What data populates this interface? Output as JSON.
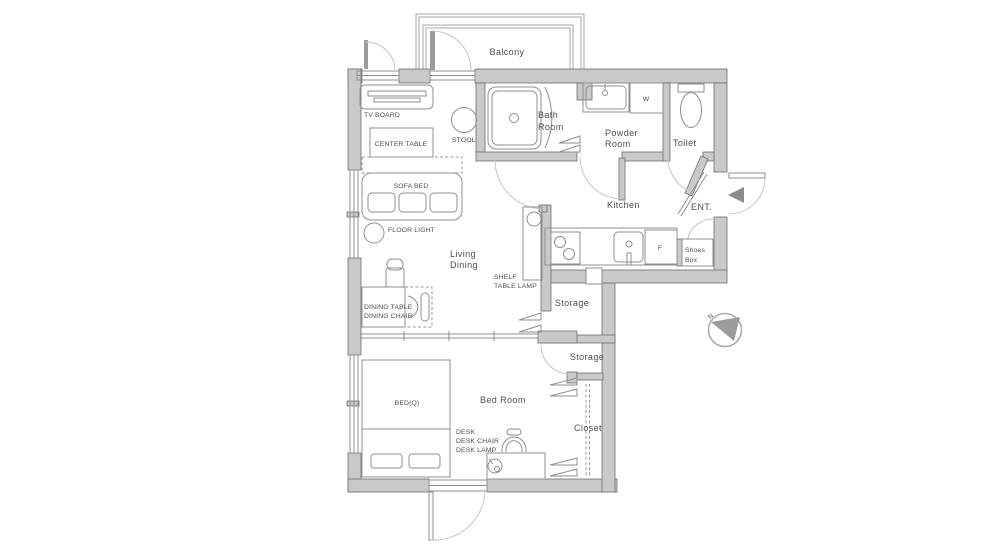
{
  "rooms": {
    "balcony": "Balcony",
    "bath": [
      "Bath",
      "Room"
    ],
    "powder": [
      "Powder",
      "Room"
    ],
    "toilet": "Toilet",
    "kitchen": "Kitchen",
    "entrance": "ENT.",
    "shoes_box": [
      "Shoes",
      "Box"
    ],
    "living_dining": [
      "Living",
      "Dining"
    ],
    "storage_upper": "Storage",
    "storage_lower": "Storage",
    "bed_room": "Bed Room",
    "closet": "Closet"
  },
  "furniture": {
    "tv_board": "TV BOARD",
    "center_table": "CENTER TABLE",
    "stool": "STOOL",
    "sofa_bed": "SOFA BED",
    "floor_light": "FLOOR LIGHT",
    "dining_table": "DINING TABLE",
    "dining_chair": "DINING CHAIR",
    "shelf": "SHELF",
    "table_lamp": "TABLE LAMP",
    "bed": "BED(Q)",
    "desk": "DESK",
    "desk_chair": "DESK CHAIR",
    "desk_lamp": "DESK LAMP"
  },
  "appliances": {
    "washer": "W",
    "fridge": "F"
  },
  "compass": {
    "north": "N"
  },
  "colors": {
    "wall_fill": "#c9c9c9",
    "wall_outline": "#6e6e6e",
    "line": "#8f8f8f",
    "door_arc": "#c4c4c4",
    "text": "#4c4c4c",
    "entry_arrow": "#8c8c8c"
  }
}
